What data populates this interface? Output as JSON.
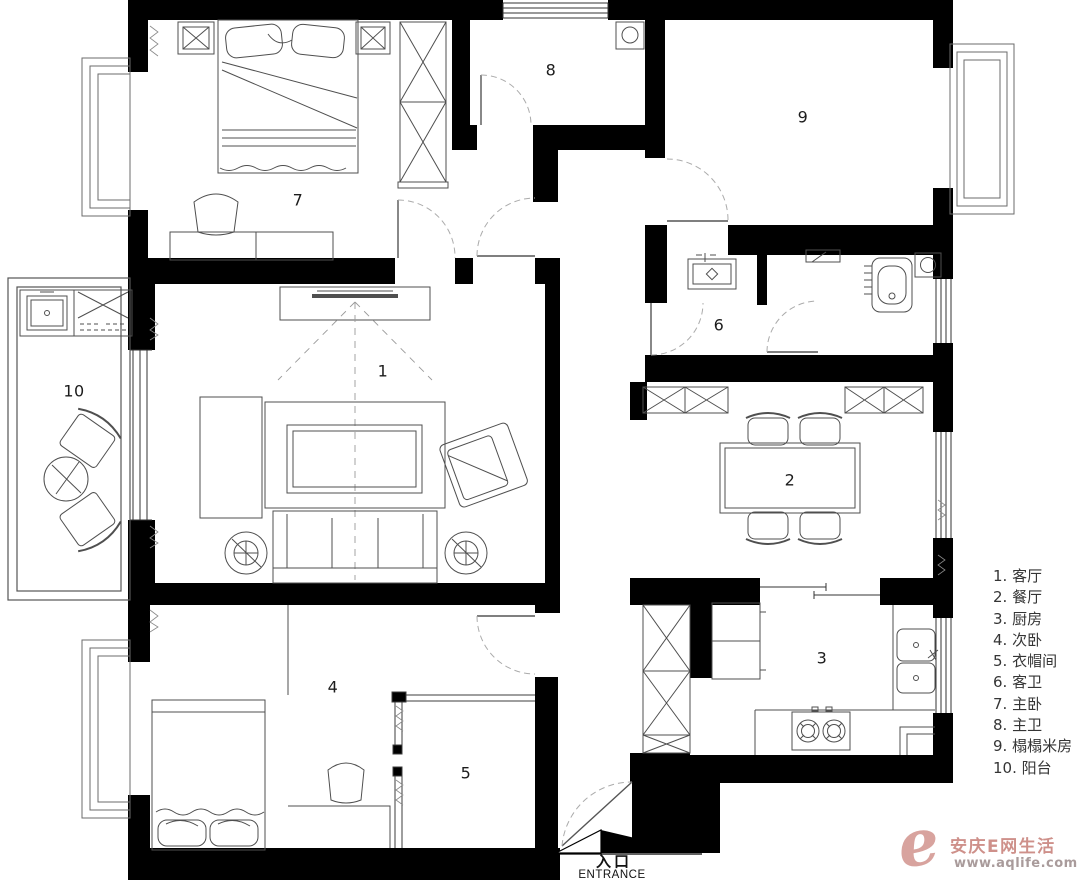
{
  "plan": {
    "entrance": {
      "cn": "入口",
      "en": "ENTRANCE"
    },
    "rooms": [
      {
        "number": "1",
        "name": "客厅"
      },
      {
        "number": "2",
        "name": "餐厅"
      },
      {
        "number": "3",
        "name": "厨房"
      },
      {
        "number": "4",
        "name": "次卧"
      },
      {
        "number": "5",
        "name": "衣帽间"
      },
      {
        "number": "6",
        "name": "客卫"
      },
      {
        "number": "7",
        "name": "主卧"
      },
      {
        "number": "8",
        "name": "主卫"
      },
      {
        "number": "9",
        "name": "榻榻米房"
      },
      {
        "number": "10",
        "name": "阳台"
      }
    ]
  },
  "legend": {
    "items": [
      "1. 客厅",
      "2. 餐厅",
      "3. 厨房",
      "4. 次卧",
      "5. 衣帽间",
      "6. 客卫",
      "7. 主卧",
      "8. 主卫",
      "9. 榻榻米房",
      "10. 阳台"
    ]
  },
  "watermark": {
    "logo_letter": "e",
    "brand": "安庆E网生活",
    "url": "www.aqlife.com"
  },
  "colors": {
    "wall": "#000000",
    "furniture_line": "#4f4f4f",
    "door_arc": "#aaaaaa",
    "background": "#ffffff",
    "watermark_accent": "#d49a94",
    "legend_text": "#353535"
  }
}
